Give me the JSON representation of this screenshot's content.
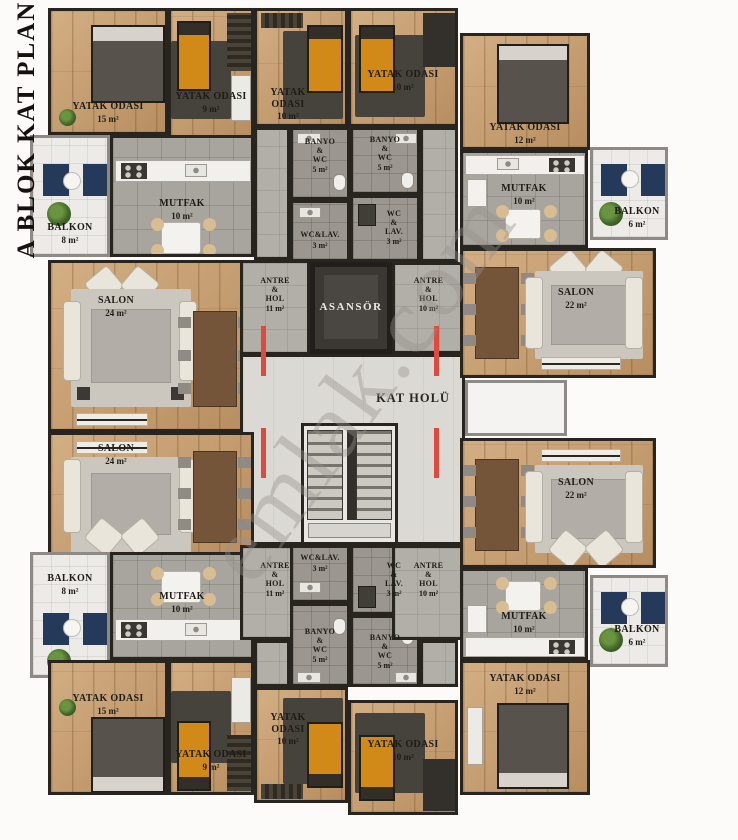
{
  "title": "A BLOK KAT PLANI",
  "watermark": "emlak.com",
  "palette": {
    "wall": "#282420",
    "wood_floor": "#c49a6b",
    "tile_floor": "#a8a49e",
    "hall_floor": "#dbd9d4",
    "balcony_floor": "#ecebe7",
    "accent_red_door": "#df4a3e",
    "accent_navy": "#25395a",
    "accent_orange_bed": "#d18a18"
  },
  "core": {
    "elevator": "ASANSÖR",
    "hall": "KAT HOLÜ"
  },
  "rooms": {
    "tl_bed15": {
      "name": "YATAK ODASI",
      "area": "15 m²"
    },
    "tl_bed9": {
      "name": "YATAK ODASI",
      "area": "9 m²"
    },
    "tl_balkon": {
      "name": "BALKON",
      "area": "8 m²"
    },
    "tl_mutfak": {
      "name": "MUTFAK",
      "area": "10 m²"
    },
    "tl_salon": {
      "name": "SALON",
      "area": "24 m²"
    },
    "tl_antre": {
      "name": "ANTRE\n&\nHOL",
      "area": "11 m²"
    },
    "tc_bed10_l": {
      "name": "YATAK ODASI",
      "area": "10 m²"
    },
    "tc_bed10_r": {
      "name": "YATAK ODASI",
      "area": "10 m²"
    },
    "tc_banyo_l": {
      "name": "BANYO\n&\nWC",
      "area": "5 m²"
    },
    "tc_banyo_r": {
      "name": "BANYO\n&\nWC",
      "area": "5 m²"
    },
    "tc_wclav_l": {
      "name": "WC&LAV.",
      "area": "3 m²"
    },
    "tc_wclav_r": {
      "name": "WC\n&\nLAV.",
      "area": "3 m²"
    },
    "tr_bed12": {
      "name": "YATAK ODASI",
      "area": "12 m²"
    },
    "tr_mutfak": {
      "name": "MUTFAK",
      "area": "10 m²"
    },
    "tr_balkon": {
      "name": "BALKON",
      "area": "6 m²"
    },
    "tr_salon": {
      "name": "SALON",
      "area": "22 m²"
    },
    "tr_antre": {
      "name": "ANTRE\n&\nHOL",
      "area": "10 m²"
    },
    "bl_salon": {
      "name": "SALON",
      "area": "24 m²"
    },
    "bl_balkon": {
      "name": "BALKON",
      "area": "8 m²"
    },
    "bl_mutfak": {
      "name": "MUTFAK",
      "area": "10 m²"
    },
    "bl_antre": {
      "name": "ANTRE\n&\nHOL",
      "area": "11 m²"
    },
    "bl_bed15": {
      "name": "YATAK ODASI",
      "area": "15 m²"
    },
    "bl_bed9": {
      "name": "YATAK ODASI",
      "area": "9 m²"
    },
    "bc_wclav_l": {
      "name": "WC&LAV.",
      "area": "3 m²"
    },
    "bc_wclav_r": {
      "name": "WC\n&\nLAV.",
      "area": "3 m²"
    },
    "bc_banyo_l": {
      "name": "BANYO\n&\nWC",
      "area": "5 m²"
    },
    "bc_banyo_r": {
      "name": "BANYO\n&\nWC",
      "area": "5 m²"
    },
    "bc_bed10_l": {
      "name": "YATAK ODASI",
      "area": "10 m²"
    },
    "bc_bed10_r": {
      "name": "YATAK ODASI",
      "area": "10 m²"
    },
    "br_salon": {
      "name": "SALON",
      "area": "22 m²"
    },
    "br_mutfak": {
      "name": "MUTFAK",
      "area": "10 m²"
    },
    "br_balkon": {
      "name": "BALKON",
      "area": "6 m²"
    },
    "br_antre": {
      "name": "ANTRE\n&\nHOL",
      "area": "10 m²"
    },
    "br_bed12": {
      "name": "YATAK ODASI",
      "area": "12 m²"
    }
  }
}
